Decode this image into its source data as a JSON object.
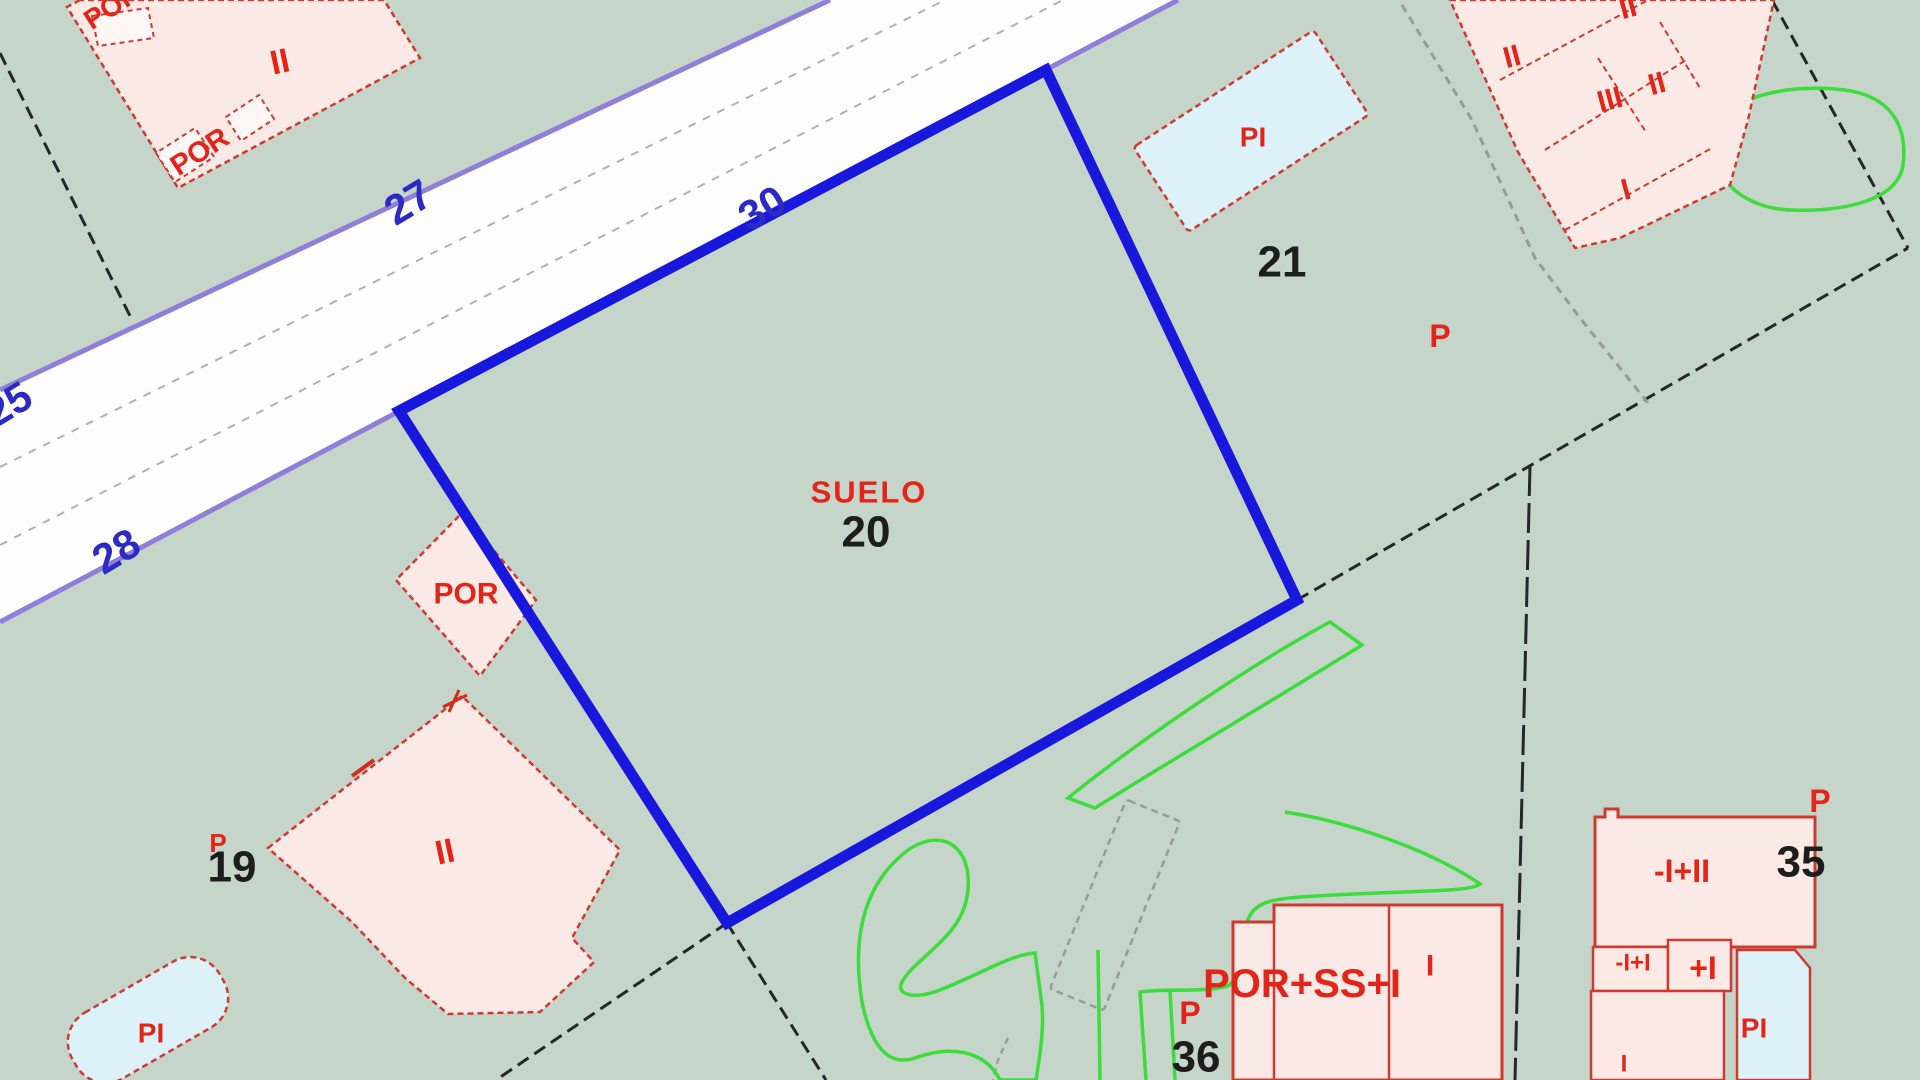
{
  "map": {
    "title": "cadastral-parcel-map",
    "viewport": {
      "width": 1920,
      "height": 1080
    },
    "colors": {
      "background": "#c6d5ca",
      "road_fill": "#fdfdfe",
      "road_edge_purple": "#8f7fd9",
      "road_centerline_gray": "#b2b2b2",
      "selected_parcel_blue": "#1818dc",
      "boundary_black": "#262626",
      "casing_gray": "#9a9a9a",
      "vegetation_green": "#3cdc3c",
      "building_fill": "#fbe9e5",
      "building_stroke": "#cf3a30",
      "annex_fill": "#fef7f5",
      "pool_fill": "#dcf2f8",
      "label_red": "#e22419",
      "label_blue": "#2b2bc4",
      "label_black": "#1d1d1d"
    },
    "shapes": [
      {
        "kind": "polygon",
        "name": "road-surface",
        "interactable": true,
        "points": "0,390 830,0 1178,0 0,622",
        "fill": "#fdfdfe",
        "stroke": "none",
        "sw": 0
      },
      {
        "kind": "line",
        "name": "road-edge-upper",
        "interactable": false,
        "x1": 0,
        "y1": 390,
        "x2": 830,
        "y2": 0,
        "stroke": "#8f7fd9",
        "sw": 5
      },
      {
        "kind": "line",
        "name": "road-edge-lower",
        "interactable": false,
        "x1": 0,
        "y1": 622,
        "x2": 1178,
        "y2": 0,
        "stroke": "#8f7fd9",
        "sw": 5
      },
      {
        "kind": "line",
        "name": "road-centerline-1",
        "interactable": false,
        "x1": 0,
        "y1": 467,
        "x2": 945,
        "y2": 0,
        "stroke": "#b2b2b2",
        "sw": 2,
        "dash": "8 8"
      },
      {
        "kind": "line",
        "name": "road-centerline-2",
        "interactable": false,
        "x1": 0,
        "y1": 545,
        "x2": 1063,
        "y2": 0,
        "stroke": "#b2b2b2",
        "sw": 2,
        "dash": "8 8"
      },
      {
        "kind": "line",
        "name": "parcel-boundary-black-a",
        "interactable": false,
        "x1": 0,
        "y1": 53,
        "x2": 132,
        "y2": 320,
        "stroke": "#262626",
        "sw": 3,
        "dash": "13 7"
      },
      {
        "kind": "line",
        "name": "parcel-boundary-black-b",
        "interactable": false,
        "x1": 1297,
        "y1": 600,
        "x2": 1908,
        "y2": 248,
        "stroke": "#262626",
        "sw": 3,
        "dash": "13 7"
      },
      {
        "kind": "line",
        "name": "parcel-boundary-black-c",
        "interactable": false,
        "x1": 1772,
        "y1": 0,
        "x2": 1908,
        "y2": 248,
        "stroke": "#262626",
        "sw": 3,
        "dash": "13 7"
      },
      {
        "kind": "line",
        "name": "parcel-boundary-black-d",
        "interactable": false,
        "x1": 1530,
        "y1": 466,
        "x2": 1515,
        "y2": 1080,
        "stroke": "#262626",
        "sw": 3,
        "dash": "30 7"
      },
      {
        "kind": "line",
        "name": "parcel-boundary-black-e",
        "interactable": false,
        "x1": 727,
        "y1": 923,
        "x2": 496,
        "y2": 1080,
        "stroke": "#262626",
        "sw": 3,
        "dash": "13 7"
      },
      {
        "kind": "line",
        "name": "parcel-boundary-black-f",
        "interactable": false,
        "x1": 727,
        "y1": 923,
        "x2": 826,
        "y2": 1080,
        "stroke": "#262626",
        "sw": 3,
        "dash": "13 7"
      },
      {
        "kind": "polyline",
        "name": "gray-casing-northeast",
        "interactable": false,
        "points": "1402,5 1472,120 1535,258 1580,318 1648,403",
        "stroke": "#9a9a9a",
        "sw": 3,
        "dash": "8 6"
      },
      {
        "kind": "rect",
        "name": "gray-casing-shed",
        "interactable": false,
        "x": 1086,
        "y": 803,
        "w": 58,
        "h": 204,
        "rx": 3,
        "transform": "rotate(22 1115 905)",
        "fill": "none",
        "stroke": "#9a9a9a",
        "sw": 2.5,
        "dash": "7 5"
      },
      {
        "kind": "polyline",
        "name": "gray-casing-tail",
        "interactable": false,
        "points": "1008,1038 998,1060 993,1080",
        "stroke": "#9a9a9a",
        "sw": 2.5,
        "dash": "6 5"
      },
      {
        "kind": "path",
        "name": "vegetation-outline-1",
        "interactable": false,
        "d": "M1725,118 C1740,95 1790,84 1845,90 C1890,96 1908,125 1903,165 C1898,200 1845,212 1790,210 C1745,208 1712,180 1718,148 Z",
        "stroke": "#3cdc3c",
        "sw": 3.5,
        "fill": "none"
      },
      {
        "kind": "path",
        "name": "vegetation-outline-2",
        "interactable": false,
        "d": "M1068,798 C1140,740 1250,665 1330,622 L1362,645 C1290,690 1180,755 1095,808 Z",
        "stroke": "#3cdc3c",
        "sw": 3.5,
        "fill": "none"
      },
      {
        "kind": "path",
        "name": "vegetation-outline-3",
        "interactable": false,
        "d": "M862,1002 C852,940 862,885 908,850 C945,825 975,850 967,897 C960,938 915,958 902,982 C895,995 915,1000 940,990 C985,972 1010,955 1035,953 L1042,1005 C1044,1030 1040,1055 1036,1080 L1000,1080 C985,1050 950,1045 915,1058 C885,1068 870,1040 862,1002 Z",
        "stroke": "#3cdc3c",
        "sw": 3.5,
        "fill": "none"
      },
      {
        "kind": "path",
        "name": "vegetation-outline-4",
        "interactable": false,
        "d": "M1285,812 C1350,822 1430,850 1480,884 C1470,893 1400,890 1300,897 C1268,900 1250,902 1245,930 C1242,958 1240,978 1228,986 C1200,993 1170,988 1140,992 C1142,1022 1144,1050 1146,1080",
        "stroke": "#3cdc3c",
        "sw": 3.5,
        "fill": "none"
      },
      {
        "kind": "path",
        "name": "vegetation-strand-1",
        "interactable": false,
        "d": "M1170,990 L1175,1080",
        "stroke": "#3cdc3c",
        "sw": 3.5,
        "fill": "none"
      },
      {
        "kind": "path",
        "name": "vegetation-strand-2",
        "interactable": false,
        "d": "M1247,989 L1256,1080",
        "stroke": "#3cdc3c",
        "sw": 3.5,
        "fill": "none"
      },
      {
        "kind": "path",
        "name": "vegetation-strand-3",
        "interactable": false,
        "d": "M1098,950 L1100,1080",
        "stroke": "#3cdc3c",
        "sw": 3.5,
        "fill": "none"
      },
      {
        "kind": "polygon",
        "name": "building-northwest",
        "interactable": false,
        "points": "80,0 67,7 178,188 420,58 384,0",
        "fill": "#fbe9e5",
        "stroke": "#cf3a30",
        "sw": 2.5,
        "dash": "6 4"
      },
      {
        "kind": "polygon",
        "name": "building-northwest-porch-a",
        "interactable": false,
        "points": "274,119 259,95 226,117 241,141",
        "fill": "#fef7f5",
        "stroke": "#cf3a30",
        "sw": 2,
        "dash": "5 4"
      },
      {
        "kind": "polygon",
        "name": "building-northwest-porch-b",
        "interactable": false,
        "points": "214,157 195,128 156,153 175,182",
        "fill": "#fef7f5",
        "stroke": "#cf3a30",
        "sw": 2,
        "dash": "5 4"
      },
      {
        "kind": "polygon",
        "name": "building-northwest-porch-c",
        "interactable": false,
        "points": "92,16 148,8 154,38 98,46",
        "fill": "#fef7f5",
        "stroke": "#cf3a30",
        "sw": 2,
        "dash": "5 4"
      },
      {
        "kind": "polygon",
        "name": "building-19",
        "interactable": false,
        "points": "268,848 462,696 620,850 572,938 594,962 540,1012 448,1014 405,978 352,922",
        "fill": "#fbe9e5",
        "stroke": "#cf3a30",
        "sw": 2.5,
        "dash": "6 4"
      },
      {
        "kind": "path",
        "name": "building-19-tick-1",
        "interactable": false,
        "d": "M352,776 L374,760",
        "stroke": "#d22b20",
        "sw": 4,
        "fill": "none"
      },
      {
        "kind": "path",
        "name": "building-19-tick-2",
        "interactable": false,
        "d": "M443,707 L467,695 M449,712 L459,690",
        "stroke": "#d22b20",
        "sw": 3,
        "fill": "none"
      },
      {
        "kind": "polygon",
        "name": "building-cluster-northeast",
        "interactable": false,
        "points": "1450,0 1774,0 1748,120 1730,185 1620,238 1575,248 1518,152",
        "fill": "#fbe9e5",
        "stroke": "#cf3a30",
        "sw": 2.5,
        "dash": "6 4"
      },
      {
        "kind": "line",
        "name": "building-cluster-wall-1",
        "interactable": false,
        "x1": 1500,
        "y1": 80,
        "x2": 1648,
        "y2": 0,
        "stroke": "#cf3a30",
        "sw": 2,
        "dash": "6 4"
      },
      {
        "kind": "line",
        "name": "building-cluster-wall-2",
        "interactable": false,
        "x1": 1545,
        "y1": 150,
        "x2": 1686,
        "y2": 60,
        "stroke": "#cf3a30",
        "sw": 2,
        "dash": "6 4"
      },
      {
        "kind": "line",
        "name": "building-cluster-wall-3",
        "interactable": false,
        "x1": 1565,
        "y1": 230,
        "x2": 1712,
        "y2": 148,
        "stroke": "#cf3a30",
        "sw": 2,
        "dash": "6 4"
      },
      {
        "kind": "line",
        "name": "building-cluster-wall-4",
        "interactable": false,
        "x1": 1660,
        "y1": 22,
        "x2": 1700,
        "y2": 88,
        "stroke": "#cf3a30",
        "sw": 2,
        "dash": "6 4"
      },
      {
        "kind": "line",
        "name": "building-cluster-wall-5",
        "interactable": false,
        "x1": 1598,
        "y1": 58,
        "x2": 1646,
        "y2": 132,
        "stroke": "#cf3a30",
        "sw": 2,
        "dash": "6 4"
      },
      {
        "kind": "polygon",
        "name": "porch-por-parcel20",
        "interactable": false,
        "points": "462,513 536,600 480,676 396,580",
        "fill": "#fbe9e5",
        "stroke": "#cf3a30",
        "sw": 2.5,
        "dash": "6 4"
      },
      {
        "kind": "polygon",
        "name": "building-36",
        "interactable": false,
        "points": "1233,922 1274,922 1274,905 1502,905 1502,1080 1233,1080",
        "fill": "#fbe9e5",
        "stroke": "#cf3a30",
        "sw": 3
      },
      {
        "kind": "line",
        "name": "building-36-wall-1",
        "interactable": false,
        "x1": 1274,
        "y1": 922,
        "x2": 1274,
        "y2": 1080,
        "stroke": "#cf3a30",
        "sw": 2.5
      },
      {
        "kind": "line",
        "name": "building-36-wall-2",
        "interactable": false,
        "x1": 1389,
        "y1": 905,
        "x2": 1389,
        "y2": 1080,
        "stroke": "#cf3a30",
        "sw": 2.5
      },
      {
        "kind": "polygon",
        "name": "building-35-main",
        "interactable": false,
        "points": "1595,817 1605,817 1605,809 1618,809 1618,817 1815,817 1815,947 1595,947",
        "fill": "#fbe9e5",
        "stroke": "#cf3a30",
        "sw": 3
      },
      {
        "kind": "polygon",
        "name": "building-35-annex-a",
        "interactable": false,
        "points": "1593,947 1668,947 1668,991 1593,991",
        "fill": "#fbe9e5",
        "stroke": "#cf3a30",
        "sw": 2.5
      },
      {
        "kind": "polygon",
        "name": "building-35-annex-b",
        "interactable": false,
        "points": "1668,940 1731,940 1731,991 1668,991",
        "fill": "#fbe9e5",
        "stroke": "#cf3a30",
        "sw": 2.5
      },
      {
        "kind": "polygon",
        "name": "building-35-annex-c",
        "interactable": false,
        "points": "1591,991 1724,991 1724,1080 1591,1080",
        "fill": "#fbe9e5",
        "stroke": "#cf3a30",
        "sw": 2.5
      },
      {
        "kind": "polygon",
        "name": "pool-parcel-35",
        "interactable": false,
        "points": "1737,950 1795,950 1810,968 1810,1080 1737,1080",
        "fill": "#dcf2f8",
        "stroke": "#cf3a30",
        "sw": 2.5
      },
      {
        "kind": "rect",
        "name": "pool-parcel-21",
        "interactable": false,
        "x": 1143.5,
        "y": 80.5,
        "w": 215,
        "h": 101,
        "rx": 4,
        "transform": "rotate(-33 1251 131)",
        "fill": "#dcf2f8",
        "stroke": "#cf3a30",
        "sw": 2.5,
        "dash": "6 4"
      },
      {
        "kind": "rect",
        "name": "pool-southwest",
        "interactable": false,
        "x": 63,
        "y": 982,
        "w": 170,
        "h": 76,
        "rx": 34,
        "transform": "rotate(-30 148 1020)",
        "fill": "#dcf2f8",
        "stroke": "#cf3a30",
        "sw": 2.5,
        "dash": "6 4"
      },
      {
        "kind": "polygon",
        "name": "parcel-20-boundary",
        "interactable": true,
        "points": "399,411 1046,70 1297,600 727,923",
        "fill": "none",
        "stroke": "#1818dc",
        "sw": 11
      }
    ],
    "labels": [
      {
        "name": "road-number-25",
        "text": "25",
        "x": 8,
        "y": 404,
        "size": 42,
        "color": "#2b2bc4",
        "weight": 600,
        "rotate": -31
      },
      {
        "name": "road-number-27",
        "text": "27",
        "x": 408,
        "y": 202,
        "size": 42,
        "color": "#2b2bc4",
        "weight": 600,
        "rotate": -31
      },
      {
        "name": "road-number-30",
        "text": "30",
        "x": 762,
        "y": 208,
        "size": 42,
        "color": "#2b2bc4",
        "weight": 600,
        "rotate": -31
      },
      {
        "name": "road-number-28",
        "text": "28",
        "x": 116,
        "y": 551,
        "size": 42,
        "color": "#2b2bc4",
        "weight": 600,
        "rotate": -31
      },
      {
        "name": "parcel-number-20",
        "text": "20",
        "x": 866,
        "y": 532,
        "size": 44,
        "color": "#1d1d1d",
        "weight": 600,
        "rotate": 0
      },
      {
        "name": "parcel-number-21",
        "text": "21",
        "x": 1282,
        "y": 262,
        "size": 44,
        "color": "#1d1d1d",
        "weight": 600,
        "rotate": 0
      },
      {
        "name": "parcel-number-19",
        "text": "19",
        "x": 232,
        "y": 867,
        "size": 44,
        "color": "#1d1d1d",
        "weight": 600,
        "rotate": 0
      },
      {
        "name": "parcel-number-35",
        "text": "35",
        "x": 1801,
        "y": 862,
        "size": 44,
        "color": "#1d1d1d",
        "weight": 600,
        "rotate": 0
      },
      {
        "name": "parcel-number-36",
        "text": "36",
        "x": 1196,
        "y": 1057,
        "size": 44,
        "color": "#1d1d1d",
        "weight": 600,
        "rotate": 0
      },
      {
        "name": "landuse-label-suelo",
        "text": "SUELO",
        "x": 869,
        "y": 492,
        "size": 31,
        "color": "#e22419",
        "weight": 700,
        "rotate": 0,
        "ls": 2
      },
      {
        "name": "building-label-por-parcel20",
        "text": "POR",
        "x": 466,
        "y": 594,
        "size": 30,
        "color": "#e22419",
        "weight": 700,
        "rotate": 0
      },
      {
        "name": "building-label-por-northwest",
        "text": "POR",
        "x": 200,
        "y": 152,
        "size": 29,
        "color": "#e22419",
        "weight": 700,
        "rotate": -33
      },
      {
        "name": "building-label-por-top-edge",
        "text": "POR",
        "x": 112,
        "y": 6,
        "size": 28,
        "color": "#e22419",
        "weight": 700,
        "rotate": -33
      },
      {
        "name": "building-label-por-ss-i",
        "text": "POR+SS+I",
        "x": 1302,
        "y": 984,
        "size": 40,
        "color": "#e22419",
        "weight": 700,
        "rotate": 0
      },
      {
        "name": "building-label-i-36",
        "text": "I",
        "x": 1430,
        "y": 966,
        "size": 30,
        "color": "#e22419",
        "weight": 700,
        "rotate": 0
      },
      {
        "name": "marker-p-parcel21",
        "text": "P",
        "x": 1440,
        "y": 336,
        "size": 32,
        "color": "#e22419",
        "weight": 700,
        "rotate": 0
      },
      {
        "name": "marker-p-parcel35",
        "text": "P",
        "x": 1820,
        "y": 801,
        "size": 32,
        "color": "#e22419",
        "weight": 700,
        "rotate": 0
      },
      {
        "name": "marker-p-parcel36",
        "text": "P",
        "x": 1190,
        "y": 1013,
        "size": 32,
        "color": "#e22419",
        "weight": 700,
        "rotate": 0
      },
      {
        "name": "marker-p-parcel19",
        "text": "P",
        "x": 218,
        "y": 843,
        "size": 26,
        "color": "#e22419",
        "weight": 700,
        "rotate": 0
      },
      {
        "name": "floors-label-ii-northwest",
        "text": "II",
        "x": 280,
        "y": 62,
        "size": 34,
        "color": "#e22419",
        "weight": 700,
        "rotate": -12
      },
      {
        "name": "floors-label-ii-19",
        "text": "II",
        "x": 445,
        "y": 852,
        "size": 34,
        "color": "#e22419",
        "weight": 700,
        "rotate": -12
      },
      {
        "name": "floors-label-ii-cluster-1",
        "text": "II",
        "x": 1512,
        "y": 57,
        "size": 30,
        "color": "#e22419",
        "weight": 700,
        "rotate": -15
      },
      {
        "name": "floors-label-ii-cluster-2",
        "text": "II",
        "x": 1628,
        "y": 8,
        "size": 30,
        "color": "#e22419",
        "weight": 700,
        "rotate": -15
      },
      {
        "name": "floors-label-iii-cluster",
        "text": "III",
        "x": 1610,
        "y": 100,
        "size": 30,
        "color": "#e22419",
        "weight": 700,
        "rotate": -15
      },
      {
        "name": "floors-label-ii-cluster-3",
        "text": "II",
        "x": 1657,
        "y": 84,
        "size": 30,
        "color": "#e22419",
        "weight": 700,
        "rotate": -15
      },
      {
        "name": "floors-label-i-cluster",
        "text": "I",
        "x": 1626,
        "y": 190,
        "size": 30,
        "color": "#e22419",
        "weight": 700,
        "rotate": -15
      },
      {
        "name": "floors-label-35-main",
        "text": "-I+II",
        "x": 1682,
        "y": 871,
        "size": 32,
        "color": "#e22419",
        "weight": 700,
        "rotate": 0
      },
      {
        "name": "floors-label-35-annex-a",
        "text": "-I+I",
        "x": 1633,
        "y": 963,
        "size": 24,
        "color": "#e22419",
        "weight": 700,
        "rotate": 0
      },
      {
        "name": "floors-label-35-annex-b",
        "text": "+I",
        "x": 1703,
        "y": 968,
        "size": 32,
        "color": "#e22419",
        "weight": 800,
        "rotate": 0
      },
      {
        "name": "floors-label-35-annex-c",
        "text": "I",
        "x": 1624,
        "y": 1064,
        "size": 24,
        "color": "#e22419",
        "weight": 700,
        "rotate": 0
      },
      {
        "name": "pool-label-pi-parcel21",
        "text": "PI",
        "x": 1253,
        "y": 137,
        "size": 28,
        "color": "#e22419",
        "weight": 700,
        "rotate": 0
      },
      {
        "name": "pool-label-pi-southwest",
        "text": "PI",
        "x": 151,
        "y": 1033,
        "size": 28,
        "color": "#e22419",
        "weight": 700,
        "rotate": 0
      },
      {
        "name": "pool-label-pi-parcel35",
        "text": "PI",
        "x": 1754,
        "y": 1028,
        "size": 28,
        "color": "#e22419",
        "weight": 700,
        "rotate": 0
      }
    ]
  }
}
